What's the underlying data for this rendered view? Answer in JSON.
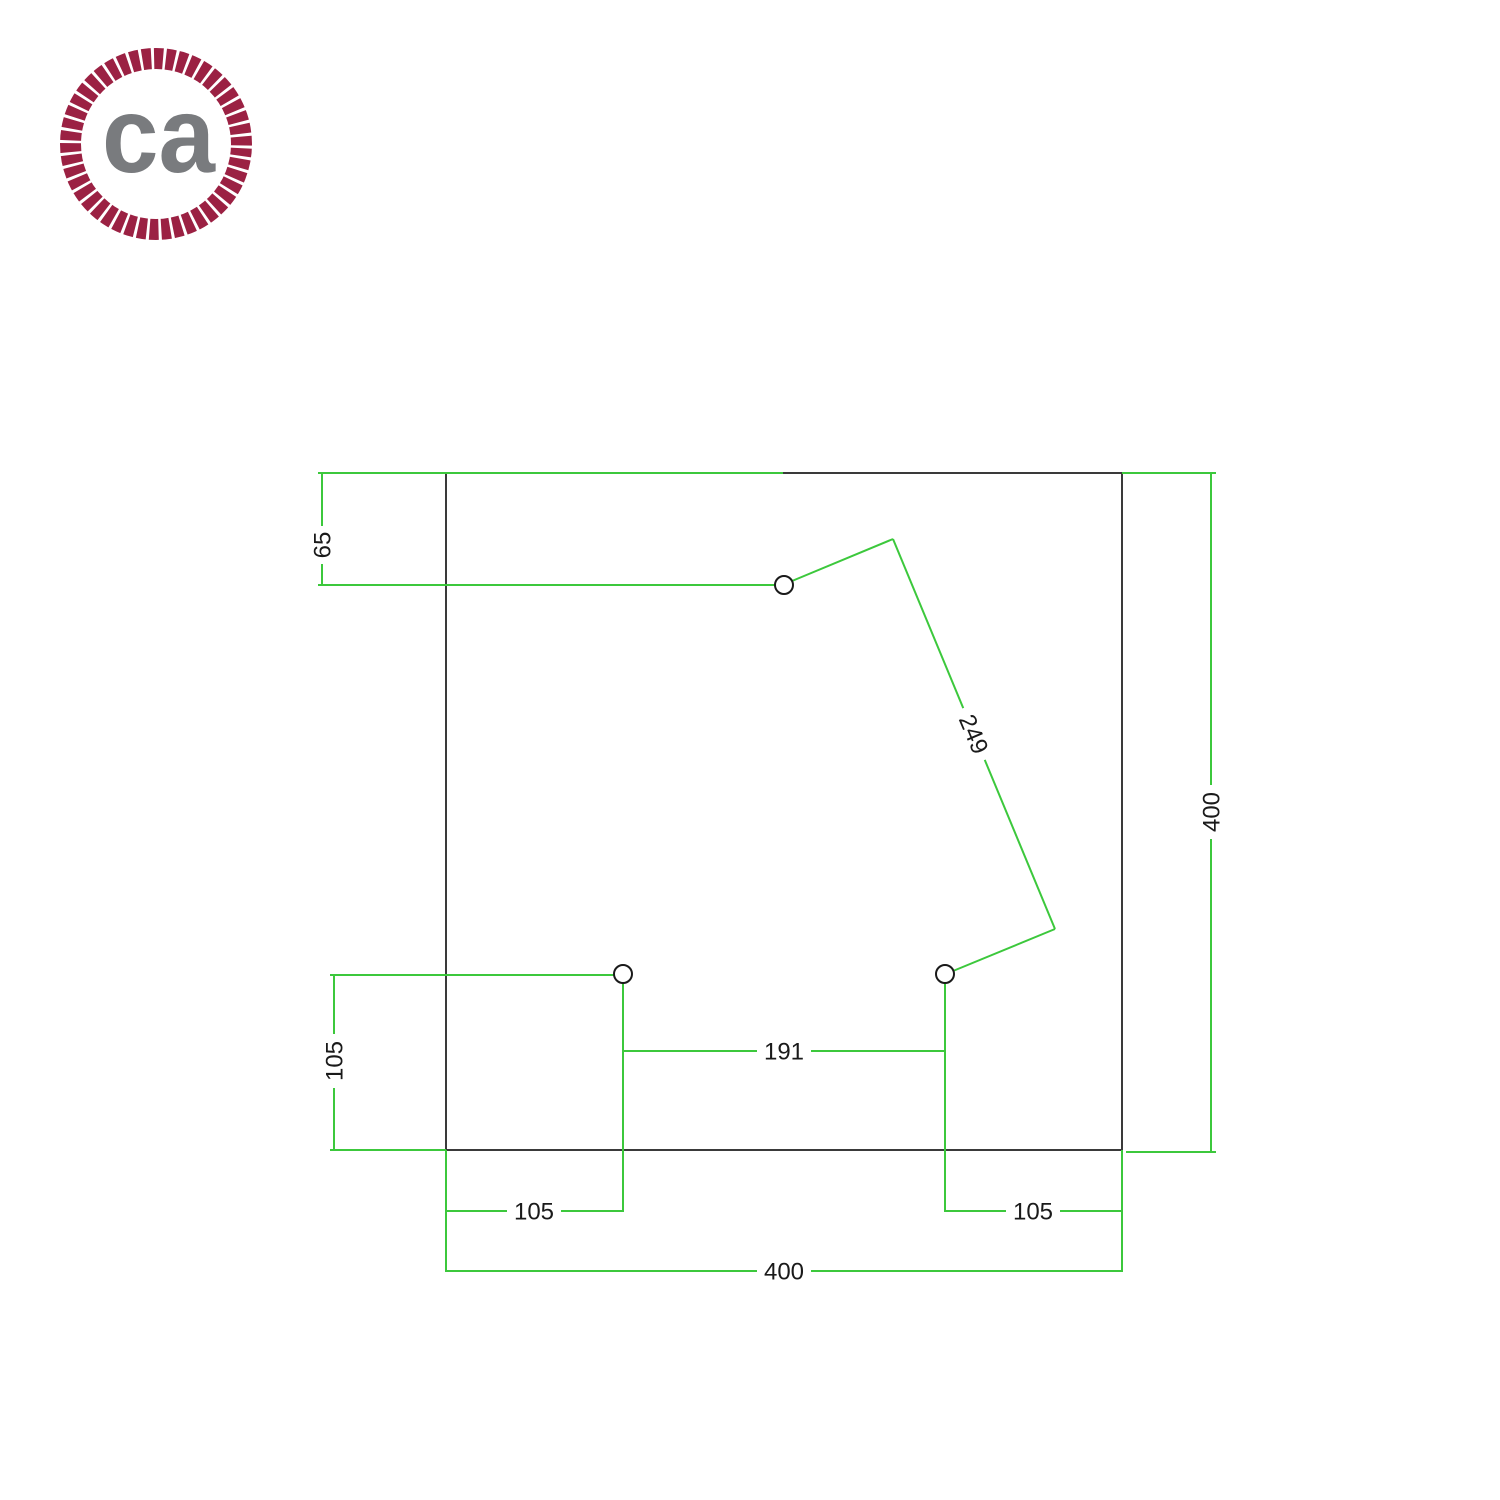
{
  "logo": {
    "text": "ca"
  },
  "colors": {
    "dimension_line": "#3cc83c",
    "outline": "#3a3a3a",
    "label_text": "#1a1a1a",
    "hole_outline": "#1a1a1a",
    "logo_ring": "#9b2143",
    "logo_text": "#797b7e"
  },
  "drawing": {
    "plate": {
      "width_label": "400",
      "height_label": "400"
    },
    "dimensions": {
      "top_hole_offset": "65",
      "top_to_bottom_right_hole": "249",
      "left_hole_vertical_offset": "105",
      "bottom_holes_spacing": "191",
      "bottom_left_hole_offset": "105",
      "bottom_right_hole_offset": "105",
      "side_height": "400",
      "side_width": "400"
    }
  }
}
